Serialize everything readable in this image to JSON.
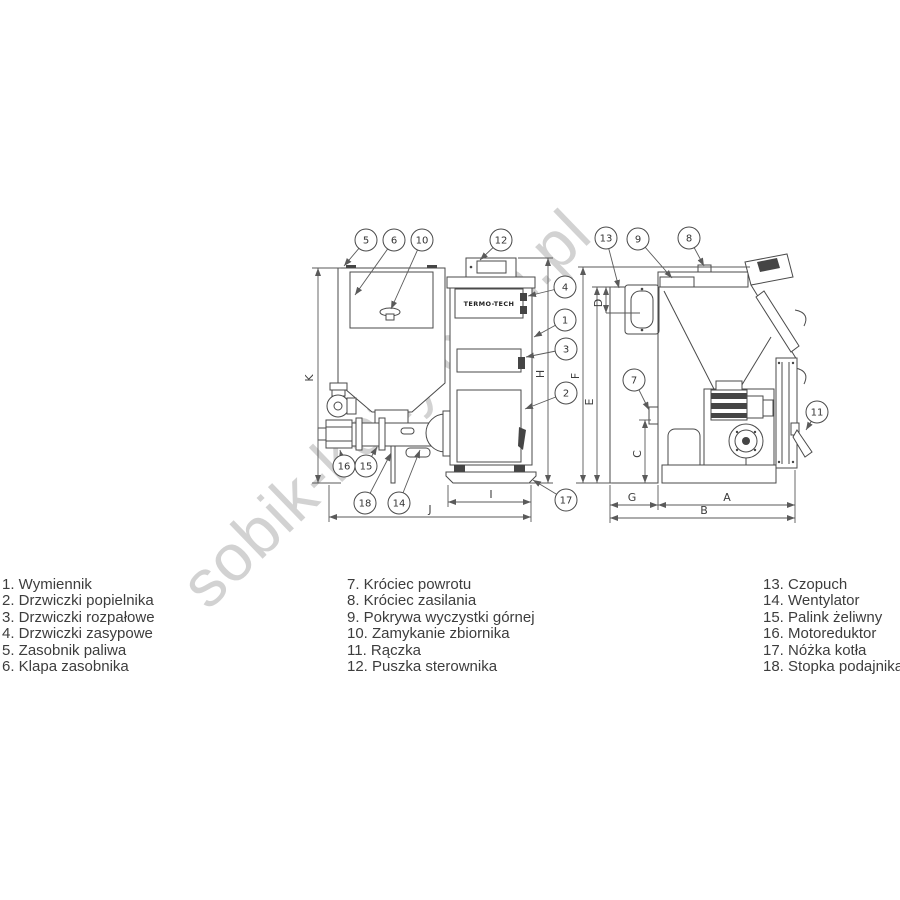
{
  "watermark": "sobik-kotly.com.pl",
  "brand": "TERMO-TECH",
  "parts_list": {
    "columns": [
      {
        "items": [
          {
            "num": "1.",
            "label": "Wymiennik"
          },
          {
            "num": "2.",
            "label": "Drzwiczki popielnika"
          },
          {
            "num": "3.",
            "label": "Drzwiczki rozpałowe"
          },
          {
            "num": "4.",
            "label": "Drzwiczki zasypowe"
          },
          {
            "num": "5.",
            "label": "Zasobnik paliwa"
          },
          {
            "num": "6.",
            "label": "Klapa zasobnika"
          }
        ]
      },
      {
        "items": [
          {
            "num": "7.",
            "label": "Króciec powrotu"
          },
          {
            "num": "8.",
            "label": "Króciec zasilania"
          },
          {
            "num": "9.",
            "label": "Pokrywa wyczystki górnej"
          },
          {
            "num": "10.",
            "label": "Zamykanie zbiornika"
          },
          {
            "num": "11.",
            "label": "Rączka"
          },
          {
            "num": "12.",
            "label": "Puszka sterownika"
          }
        ]
      },
      {
        "items": [
          {
            "num": "13.",
            "label": "Czopuch"
          },
          {
            "num": "14.",
            "label": "Wentylator"
          },
          {
            "num": "15.",
            "label": "Palink żeliwny"
          },
          {
            "num": "16.",
            "label": "Motoreduktor"
          },
          {
            "num": "17.",
            "label": "Nóżka kotła"
          },
          {
            "num": "18.",
            "label": "Stopka podajnika"
          }
        ]
      }
    ]
  },
  "diagram": {
    "callouts": [
      {
        "n": "1",
        "cx": 565,
        "cy": 320,
        "tx": 534,
        "ty": 337
      },
      {
        "n": "2",
        "cx": 566,
        "cy": 393,
        "tx": 525,
        "ty": 409
      },
      {
        "n": "3",
        "cx": 566,
        "cy": 349,
        "tx": 526,
        "ty": 357
      },
      {
        "n": "4",
        "cx": 565,
        "cy": 287,
        "tx": 528,
        "ty": 296
      },
      {
        "n": "5",
        "cx": 366,
        "cy": 240,
        "tx": 344,
        "ty": 266
      },
      {
        "n": "6",
        "cx": 394,
        "cy": 240,
        "tx": 355,
        "ty": 295
      },
      {
        "n": "7",
        "cx": 634,
        "cy": 380,
        "tx": 649,
        "ty": 410
      },
      {
        "n": "8",
        "cx": 689,
        "cy": 238,
        "tx": 704,
        "ty": 266
      },
      {
        "n": "9",
        "cx": 638,
        "cy": 239,
        "tx": 672,
        "ty": 278
      },
      {
        "n": "10",
        "cx": 422,
        "cy": 240,
        "tx": 391,
        "ty": 309
      },
      {
        "n": "11",
        "cx": 817,
        "cy": 412,
        "tx": 806,
        "ty": 430
      },
      {
        "n": "12",
        "cx": 501,
        "cy": 240,
        "tx": 480,
        "ty": 260
      },
      {
        "n": "13",
        "cx": 606,
        "cy": 238,
        "tx": 619,
        "ty": 288
      },
      {
        "n": "14",
        "cx": 399,
        "cy": 503,
        "tx": 420,
        "ty": 450
      },
      {
        "n": "15",
        "cx": 366,
        "cy": 466,
        "tx": 377,
        "ty": 447
      },
      {
        "n": "16",
        "cx": 344,
        "cy": 466,
        "tx": 340,
        "ty": 450
      },
      {
        "n": "17",
        "cx": 566,
        "cy": 500,
        "tx": 533,
        "ty": 480
      },
      {
        "n": "18",
        "cx": 365,
        "cy": 503,
        "tx": 391,
        "ty": 453
      }
    ],
    "dim_labels": [
      {
        "t": "K",
        "x": 313,
        "y": 378,
        "rot": -90
      },
      {
        "t": "H",
        "x": 544,
        "y": 374,
        "rot": -90
      },
      {
        "t": "I",
        "x": 491,
        "y": 498,
        "rot": 0
      },
      {
        "t": "J",
        "x": 430,
        "y": 513,
        "rot": 0
      },
      {
        "t": "F",
        "x": 579,
        "y": 376,
        "rot": -90
      },
      {
        "t": "E",
        "x": 593,
        "y": 402,
        "rot": -90
      },
      {
        "t": "D",
        "x": 602,
        "y": 303,
        "rot": -90
      },
      {
        "t": "C",
        "x": 641,
        "y": 454,
        "rot": -90
      },
      {
        "t": "G",
        "x": 632,
        "y": 501,
        "rot": 0
      },
      {
        "t": "A",
        "x": 727,
        "y": 501,
        "rot": 0
      },
      {
        "t": "B",
        "x": 704,
        "y": 514,
        "rot": 0
      }
    ]
  }
}
